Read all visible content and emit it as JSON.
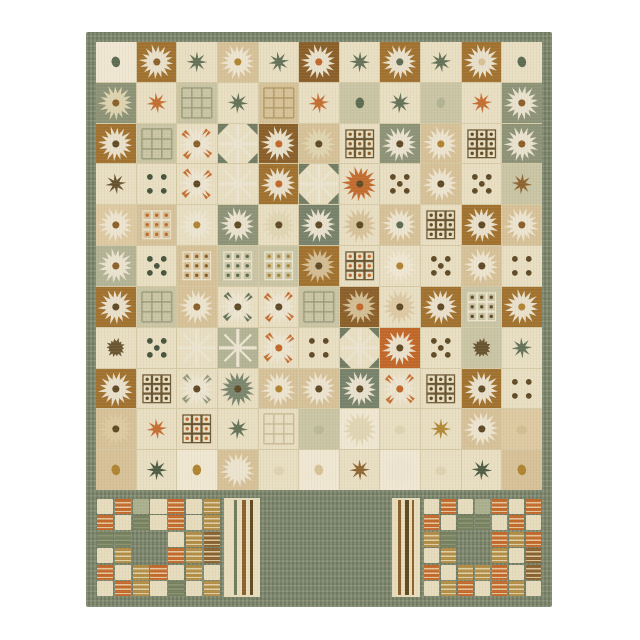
{
  "photo": {
    "subject": "patchwork-style area rug, portrait orientation, centered on white background",
    "background": "#ffffff",
    "rug_position": {
      "left": 86,
      "top": 32,
      "width": 466,
      "height": 575
    }
  },
  "palette": {
    "cream": "#e8dec2",
    "cream2": "#efe7d2",
    "tan": "#d6c198",
    "tan2": "#ddc9a2",
    "gold": "#b08430",
    "brown": "#a1722f",
    "brown2": "#8a5f2a",
    "darkbrown": "#5f4a26",
    "orange": "#c2672a",
    "sage": "#c9c5a4",
    "sage2": "#b3b396",
    "green": "#8d9377",
    "green2": "#77826a",
    "teal": "#5d6b52",
    "tealdark": "#46543e",
    "white": "#ece5d1",
    "offwhite": "#e0d5b2",
    "seam": "#d5caa5",
    "border": "#7b856a",
    "borderdark": "#6e7a5e"
  },
  "field": {
    "rows": 11,
    "cols": 11,
    "cell_format": [
      "background",
      "motif",
      "motif_color",
      "center_dot_color",
      "accent_color"
    ],
    "cells": [
      [
        [
          "cream2",
          "dot",
          "teal"
        ],
        [
          "brown",
          "flower",
          "white",
          "brown2"
        ],
        [
          "cream",
          "star",
          "teal"
        ],
        [
          "tan",
          "flower",
          "white",
          "gold"
        ],
        [
          "cream",
          "star",
          "teal"
        ],
        [
          "brown2",
          "flower",
          "white",
          "orange"
        ],
        [
          "cream",
          "star",
          "teal"
        ],
        [
          "brown",
          "flower",
          "white",
          "teal"
        ],
        [
          "cream",
          "star",
          "teal"
        ],
        [
          "brown",
          "flower",
          "white",
          "tan"
        ],
        [
          "cream",
          "dot",
          "teal"
        ]
      ],
      [
        [
          "green",
          "flower",
          "offwhite",
          "brown2"
        ],
        [
          "cream",
          "star",
          "orange"
        ],
        [
          "sage",
          "grid",
          "#9b9c7d"
        ],
        [
          "cream",
          "star",
          "teal"
        ],
        [
          "tan",
          "grid",
          "#b39a66"
        ],
        [
          "cream",
          "star",
          "orange"
        ],
        [
          "sage",
          "dot",
          "teal"
        ],
        [
          "cream",
          "star",
          "teal"
        ],
        [
          "sage",
          "dot",
          "sage2"
        ],
        [
          "cream",
          "star",
          "orange"
        ],
        [
          "green",
          "flower",
          "white",
          "brown2"
        ]
      ],
      [
        [
          "brown",
          "flower",
          "white",
          "darkbrown"
        ],
        [
          "sage",
          "grid",
          "#9b9c7d"
        ],
        [
          "cream",
          "flower",
          "white",
          "brown2",
          "orange"
        ],
        [
          "cream",
          "xstar",
          "white",
          "",
          "teal"
        ],
        [
          "brown2",
          "flower",
          "white",
          "orange"
        ],
        [
          "tan",
          "flower",
          "offwhite",
          "darkbrown"
        ],
        [
          "cream",
          "dotgrid",
          "darkbrown",
          "brown2"
        ],
        [
          "green",
          "flower",
          "white",
          "darkbrown"
        ],
        [
          "tan",
          "flower",
          "white",
          "gold"
        ],
        [
          "cream",
          "dotgrid",
          "darkbrown",
          "darkbrown"
        ],
        [
          "green",
          "flower",
          "white",
          "brown2"
        ]
      ],
      [
        [
          "cream",
          "star",
          "darkbrown"
        ],
        [
          "cream",
          "dice4",
          "tealdark"
        ],
        [
          "cream",
          "flower",
          "white",
          "darkbrown",
          "orange"
        ],
        [
          "cream",
          "xstar",
          "white"
        ],
        [
          "brown",
          "flower",
          "white",
          "orange"
        ],
        [
          "cream",
          "xstar",
          "white",
          "",
          "teal"
        ],
        [
          "cream",
          "flower",
          "orange",
          "darkbrown"
        ],
        [
          "cream",
          "dice5",
          "darkbrown"
        ],
        [
          "tan",
          "flower",
          "white",
          "darkbrown"
        ],
        [
          "cream",
          "dice5",
          "darkbrown"
        ],
        [
          "sage",
          "star",
          "brown2"
        ]
      ],
      [
        [
          "tan2",
          "flower",
          "white",
          "brown2"
        ],
        [
          "tan",
          "dotgrid",
          "white",
          "orange"
        ],
        [
          "cream",
          "flower",
          "white",
          "gold"
        ],
        [
          "green",
          "flower",
          "white",
          "darkbrown"
        ],
        [
          "cream",
          "flower",
          "offwhite",
          "darkbrown"
        ],
        [
          "green2",
          "flower",
          "white",
          "darkbrown"
        ],
        [
          "cream",
          "flower",
          "tan",
          "darkbrown"
        ],
        [
          "tan",
          "flower",
          "white",
          "teal"
        ],
        [
          "cream",
          "dotgrid",
          "darkbrown",
          "darkbrown"
        ],
        [
          "brown",
          "flower",
          "white",
          "darkbrown"
        ],
        [
          "tan",
          "flower",
          "white",
          "brown2"
        ]
      ],
      [
        [
          "sage2",
          "flower",
          "white",
          "brown2"
        ],
        [
          "cream",
          "dice5",
          "tealdark"
        ],
        [
          "tan",
          "dotgrid",
          "white",
          "brown2"
        ],
        [
          "sage",
          "dotgrid",
          "cream2",
          "teal"
        ],
        [
          "sage",
          "dotgrid",
          "cream2",
          "gold"
        ],
        [
          "brown",
          "flower",
          "tan",
          "darkbrown"
        ],
        [
          "cream",
          "dotgrid",
          "darkbrown",
          "orange"
        ],
        [
          "cream",
          "flower",
          "cream2",
          "gold"
        ],
        [
          "cream",
          "dice5",
          "darkbrown"
        ],
        [
          "tan",
          "flower",
          "white",
          "darkbrown"
        ],
        [
          "cream",
          "dice4",
          "darkbrown"
        ]
      ],
      [
        [
          "brown",
          "flower",
          "white",
          "darkbrown"
        ],
        [
          "sage",
          "grid",
          "#9b9c7d"
        ],
        [
          "tan",
          "flower",
          "white",
          "brown2"
        ],
        [
          "cream",
          "flower",
          "white",
          "darkbrown",
          "teal"
        ],
        [
          "cream",
          "flower",
          "white",
          "darkbrown",
          "orange"
        ],
        [
          "sage",
          "grid",
          "#9b9c7d"
        ],
        [
          "brown2",
          "flower",
          "tan",
          "orange"
        ],
        [
          "cream",
          "flower",
          "tan2",
          "darkbrown"
        ],
        [
          "brown",
          "flower",
          "white",
          "darkbrown"
        ],
        [
          "sage",
          "dotgrid",
          "cream2",
          "darkbrown"
        ],
        [
          "brown",
          "flower",
          "white",
          "gold"
        ]
      ],
      [
        [
          "cream",
          "blob",
          "darkbrown"
        ],
        [
          "cream",
          "dice5",
          "tealdark"
        ],
        [
          "cream",
          "xstar",
          "white"
        ],
        [
          "sage2",
          "xstar",
          "white"
        ],
        [
          "cream",
          "flower",
          "white",
          "orange",
          "orange"
        ],
        [
          "cream",
          "dice4",
          "darkbrown"
        ],
        [
          "cream",
          "xstar",
          "white",
          "",
          "teal"
        ],
        [
          "orange",
          "flower",
          "white",
          "darkbrown"
        ],
        [
          "cream",
          "dice5",
          "darkbrown"
        ],
        [
          "sage",
          "blob",
          "darkbrown"
        ],
        [
          "cream",
          "star",
          "teal"
        ]
      ],
      [
        [
          "brown",
          "flower",
          "white",
          "darkbrown"
        ],
        [
          "cream",
          "dotgrid",
          "darkbrown",
          "darkbrown"
        ],
        [
          "cream",
          "flower",
          "white",
          "darkbrown",
          "green"
        ],
        [
          "cream",
          "flower",
          "green2",
          "darkbrown"
        ],
        [
          "tan",
          "flower",
          "white",
          "gold"
        ],
        [
          "tan",
          "flower",
          "white",
          "darkbrown"
        ],
        [
          "green2",
          "flower",
          "white",
          "darkbrown"
        ],
        [
          "cream",
          "flower",
          "white",
          "orange",
          "orange"
        ],
        [
          "cream",
          "dotgrid",
          "darkbrown",
          "darkbrown"
        ],
        [
          "brown",
          "flower",
          "white",
          "darkbrown"
        ],
        [
          "cream",
          "dice4",
          "darkbrown"
        ]
      ],
      [
        [
          "tan",
          "flower",
          "tan2",
          "darkbrown"
        ],
        [
          "cream",
          "star",
          "orange"
        ],
        [
          "cream",
          "dotgrid",
          "darkbrown",
          "orange"
        ],
        [
          "cream",
          "star",
          "teal"
        ],
        [
          "cream",
          "grid",
          "#c9bc96"
        ],
        [
          "sage",
          "fade",
          "#b5b294"
        ],
        [
          "cream2",
          "flower",
          "offwhite"
        ],
        [
          "cream",
          "fade",
          "#d8cda9"
        ],
        [
          "cream",
          "star",
          "gold"
        ],
        [
          "tan",
          "flower",
          "white",
          "darkbrown"
        ],
        [
          "tan2",
          "fade",
          "#cdb98e"
        ]
      ],
      [
        [
          "tan",
          "dot",
          "gold"
        ],
        [
          "cream",
          "star",
          "tealdark"
        ],
        [
          "cream2",
          "dot",
          "gold"
        ],
        [
          "tan",
          "flower",
          "white"
        ],
        [
          "cream",
          "fade",
          "#d8cda9"
        ],
        [
          "cream2",
          "dot",
          "tan"
        ],
        [
          "cream",
          "star",
          "brown2"
        ],
        [
          "cream2",
          "flower",
          "white"
        ],
        [
          "cream",
          "fade",
          "#d8cda9"
        ],
        [
          "cream",
          "star",
          "tealdark"
        ],
        [
          "tan",
          "dot",
          "gold"
        ]
      ]
    ]
  },
  "bottom_section": {
    "band_height": 8,
    "block_colors": {
      "C": {
        "style": "solid",
        "base": "#e6dcbd"
      },
      "O": {
        "style": "stripes",
        "base": "#c4692c",
        "stripe": "#e2c79c"
      },
      "G": {
        "style": "stripes",
        "base": "#75805f",
        "stripe": "#8b9573"
      },
      "g": {
        "style": "solid",
        "base": "#aab08e"
      },
      "T": {
        "style": "stripes",
        "base": "#b28d46",
        "stripe": "#e0d0a8"
      },
      "B": {
        "style": "stripes",
        "base": "#8a6231",
        "stripe": "#d9c69a"
      }
    },
    "panels": [
      {
        "type": "patchwork",
        "name": "patchwork-left",
        "width": 125,
        "rows": [
          "COgCOCT",
          "OCGCOCT",
          "GGXXCTB",
          "CTXXOTB",
          "OCTOCTC",
          "COTCGCT"
        ],
        "star": {
          "col": 2,
          "row": 2,
          "colspan": 2,
          "rowspan": 2,
          "bg": "#eae0c4",
          "ray": "#8a5f2a",
          "ray2": "#f2ecd9"
        }
      },
      {
        "type": "stripes",
        "name": "stripes-left",
        "width": 36,
        "bg": "#e7ddbd",
        "stripes": [
          {
            "x": 10,
            "w": 3,
            "color": "#6f7a5e"
          },
          {
            "x": 18,
            "w": 4,
            "color": "#8a5f2a"
          },
          {
            "x": 26,
            "w": 3,
            "color": "#5f4a20"
          }
        ]
      },
      {
        "type": "bricks",
        "name": "brick-panel-center",
        "width": 126,
        "cols": 6,
        "rows": 5,
        "brick_fill": [
          "#e9dfc2",
          "#e4d7b4",
          "#eee6cc"
        ],
        "line": "#7d8266",
        "center": {
          "w": 44,
          "h": 42,
          "fill": "#a1722f",
          "star": "#f2ecd9"
        }
      },
      {
        "type": "stripes",
        "name": "stripes-right",
        "width": 28,
        "bg": "#e7ddbd",
        "stripes": [
          {
            "x": 6,
            "w": 3,
            "color": "#8a5f2a"
          },
          {
            "x": 13,
            "w": 4,
            "color": "#5f4a20"
          },
          {
            "x": 20,
            "w": 2,
            "color": "#8a5f2a"
          }
        ]
      },
      {
        "type": "patchwork",
        "name": "patchwork-right",
        "width": 119,
        "rows": [
          "COCgOCO",
          "OCGGCOC",
          "TGXXOTO",
          "CTXXTCB",
          "OCTTOCB",
          "CTOCOTC"
        ],
        "star": {
          "col": 2,
          "row": 2,
          "colspan": 2,
          "rowspan": 2,
          "bg": "#eae0c4",
          "ray": "#8a5f2a",
          "ray2": "#f2ecd9"
        }
      }
    ]
  }
}
